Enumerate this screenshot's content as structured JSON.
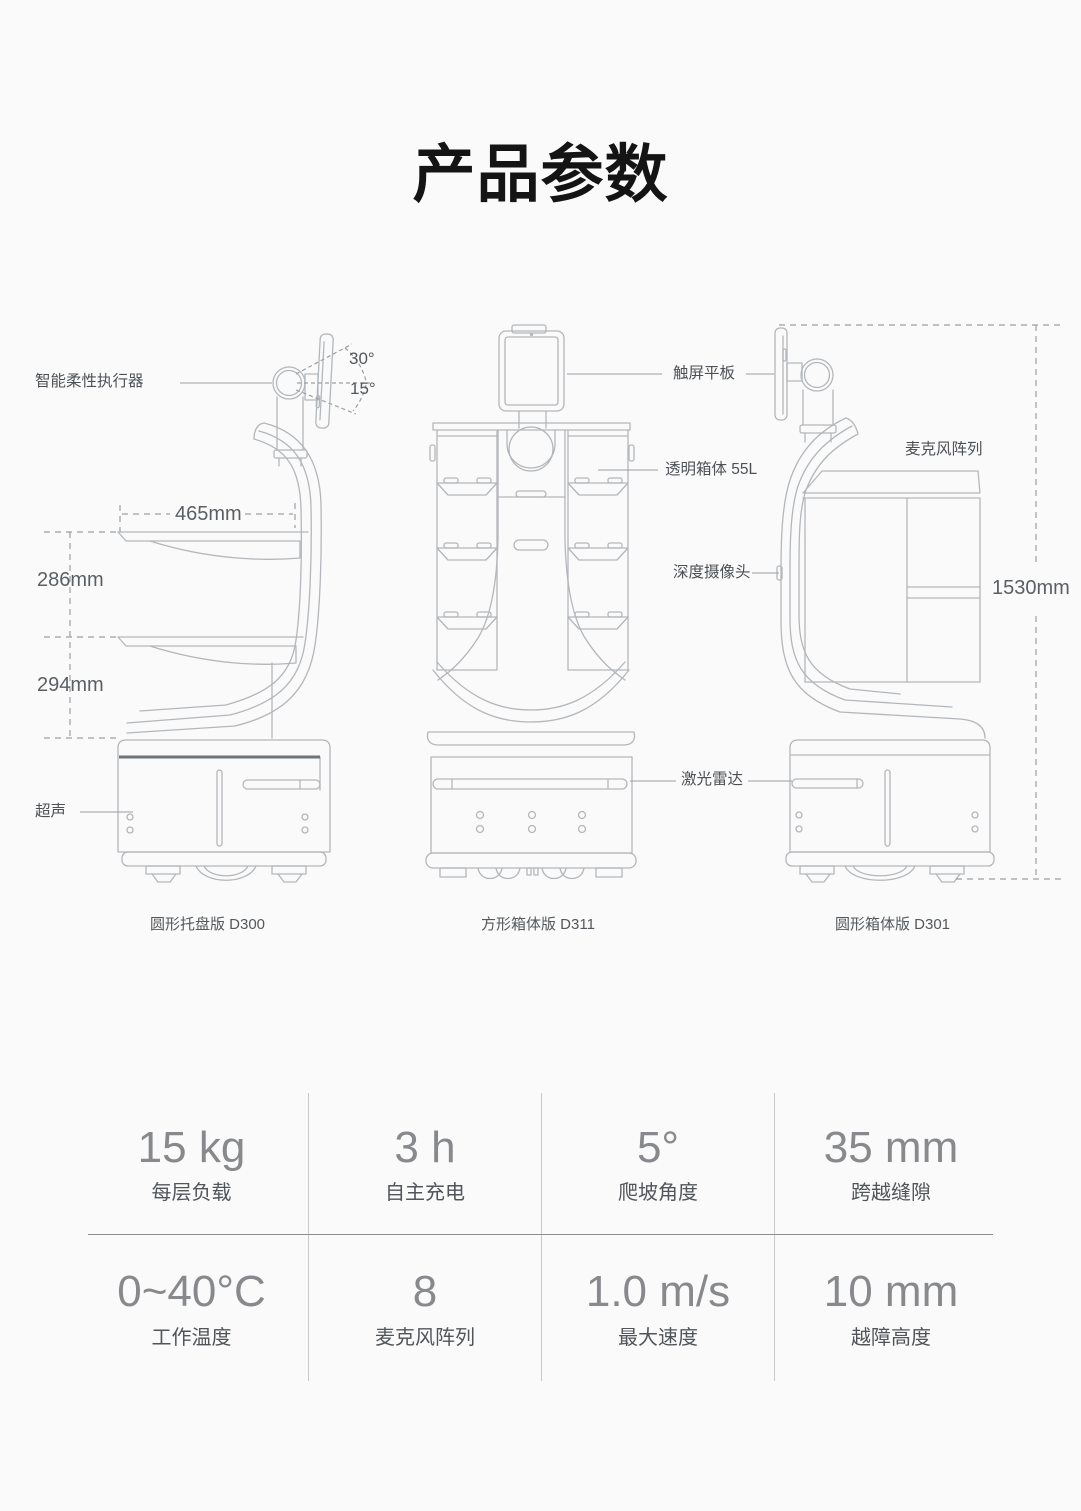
{
  "title": "产品参数",
  "diagram": {
    "callouts": {
      "actuator": "智能柔性执行器",
      "angle_up": "30°",
      "angle_down": "15°",
      "tray_depth": "465mm",
      "tray_gap_upper": "286mm",
      "tray_gap_lower": "294mm",
      "ultrasonic": "超声",
      "touchscreen": "触屏平板",
      "transparent_box": "透明箱体 55L",
      "depth_camera": "深度摄像头",
      "lidar": "激光雷达",
      "mic_array": "麦克风阵列",
      "overall_height": "1530mm"
    },
    "captions": {
      "model_left": "圆形托盘版 D300",
      "model_middle": "方形箱体版 D311",
      "model_right": "圆形箱体版 D301"
    }
  },
  "specs": {
    "items": [
      {
        "value": "15 kg",
        "label": "每层负载"
      },
      {
        "value": "3 h",
        "label": "自主充电"
      },
      {
        "value": "5°",
        "label": "爬坡角度"
      },
      {
        "value": "35 mm",
        "label": "跨越缝隙"
      },
      {
        "value": "0~40°C",
        "label": "工作温度"
      },
      {
        "value": "8",
        "label": "麦克风阵列"
      },
      {
        "value": "1.0 m/s",
        "label": "最大速度"
      },
      {
        "value": "10 mm",
        "label": "越障高度"
      }
    ]
  },
  "colors": {
    "background": "#fafafa",
    "line_art": "#b3b7bb",
    "dark_band": "#6f7478",
    "label_text": "#4d5156",
    "spec_value": "#87898c",
    "spec_label": "#515559",
    "title_text": "#141414"
  }
}
